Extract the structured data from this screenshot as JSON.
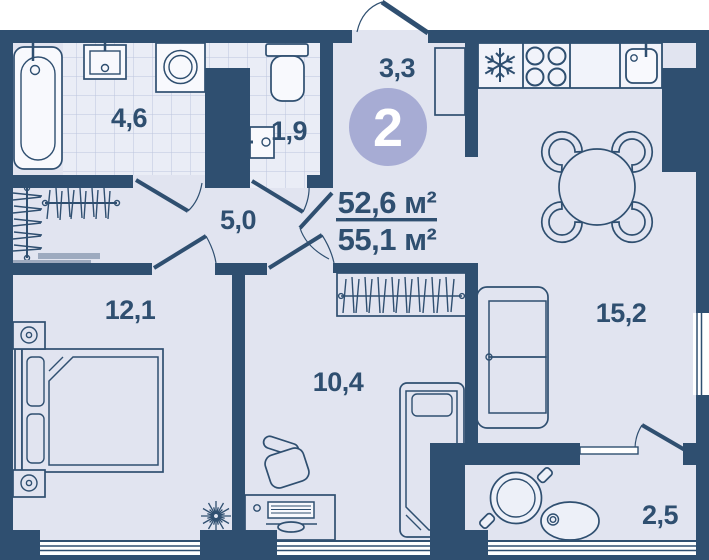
{
  "floor_plan": {
    "badge": "2",
    "area": {
      "living": "52,6 м²",
      "total": "55,1 м²"
    },
    "rooms": {
      "bathroom": "4,6",
      "toilet": "1,9",
      "entry": "3,3",
      "hallway": "5,0",
      "bedroom": "12,1",
      "study": "10,4",
      "kitchen_living": "15,2",
      "shower": "2,5"
    },
    "colors": {
      "wall": "#2f4f70",
      "floor": "#e1e4f0",
      "tile_floor": "#eaedf6",
      "tile_line": "#bcc5dd",
      "fixture": "#f8f9fd",
      "badge_fill": "#a7acd4",
      "bench": "#9daabf",
      "text": "#2f4f70"
    }
  }
}
